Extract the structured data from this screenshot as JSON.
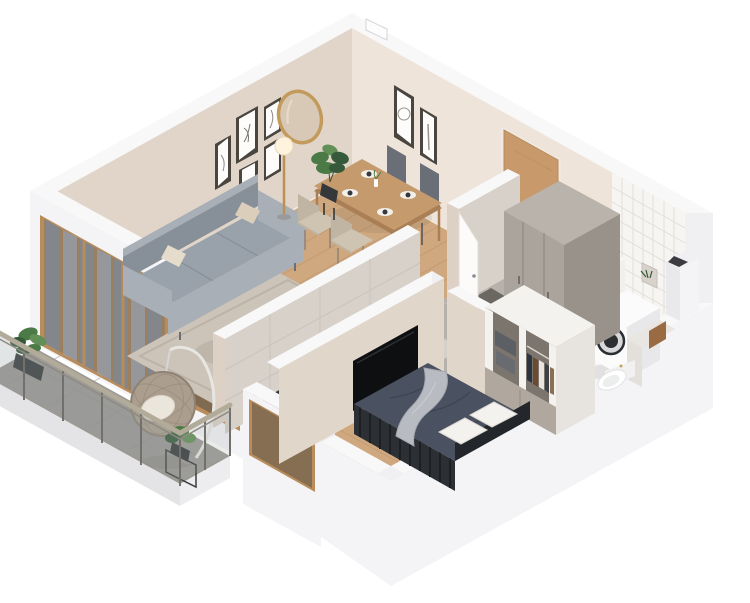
{
  "scene": {
    "title": "3D isometric cutaway render of a one-bedroom apartment floor plan",
    "background": "#ffffff"
  },
  "palette": {
    "bg": "#ffffff",
    "band": "#f8f8f9",
    "cap": "#f0f0f2",
    "outer": "#f4f4f6",
    "outerShade": "#e9e9ec",
    "wallNE": "#eee4d9",
    "wallNW": "#e1d5c9",
    "wallA": "#ddd1c5",
    "wallAside": "#d7d1ca",
    "wallB": "#e1d6ca",
    "tileWall": "#f7f5f2",
    "wood": "#cfa87f",
    "woodLine": "#b9916a",
    "hallTile": "#b6b1ab",
    "hallLine": "#c6c2bc",
    "mat": "#6b6761",
    "kitchenFloor": "#d5d0c9",
    "kitchenLine": "#c3beb7",
    "marble": "#eae8e4",
    "rug": "#ccc4b9",
    "rugLine": "#bcb3a6",
    "sofa": "#99a1aa",
    "sofaShade": "#878f98",
    "sofaLight": "#a8afb7",
    "pillowBeige": "#dbcfbc",
    "pillowBeige2": "#e6dccb",
    "tableWood": "#c59a6d",
    "tableEdge": "#aa7f55",
    "chairDark": "#6a6f77",
    "chairDarkLight": "#757a82",
    "chairLight": "#cfc4b2",
    "chairLightShade": "#c0b5a3",
    "mirrorRim": "#c29a5b",
    "mirrorFace": "#d8c8b6",
    "frameDark": "#4a463f",
    "frameFace": "#fdfcfa",
    "doorWood": "#c8996a",
    "frameWood": "#b98c5c",
    "tv": "#0d0f11",
    "counterTop": "#33363b",
    "counterFace": "#f1efec",
    "cooktop": "#141619",
    "board": "#c89a66",
    "wardrobeFront": "#aba49c",
    "wardrobeSide": "#99928a",
    "wardrobeTop": "#bab3ab",
    "partition": "#f2f0ed",
    "washer": "#fbfbfc",
    "washerShade": "#e8e8ea",
    "drum": "#2b2e31",
    "toilet": "#ffffff",
    "towel": "#9a6b42",
    "nicheFill": "#d7d2cb",
    "closetWhite": "#f4f2ef",
    "closetInner": "#7b756d",
    "drawer": "#b0a79e",
    "boxGray": "#5c6065",
    "bedDuvet": "#4a5161",
    "bedFrame": "#2c2f34",
    "headboard": "#23262b",
    "pillowWhite": "#f4f2ee",
    "throw": "#b8bbc2",
    "balconyFloor": "#9c9995",
    "balconyEdge": "#e4e4e7",
    "railTop": "#b3ab99",
    "railPost": "#73706c",
    "rattan": "#ab9e8f",
    "rattanDark": "#8f8274",
    "cushionWhite": "#ebe6dc",
    "green": "#4c7a46",
    "greenDark": "#35593a",
    "greenLight": "#628f55",
    "pot": "#35383a",
    "lampGold": "#bd9054",
    "lampGlobe": "#fff3dd",
    "shadow": "rgba(70,60,50,0.10)"
  },
  "rooms": [
    {
      "id": "living-room",
      "label": "Living room",
      "items": [
        "gray sofa",
        "beige throw pillows",
        "area rug",
        "round marble nesting coffee tables",
        "floor lamp",
        "gallery wall of framed sketches",
        "round gold mirror",
        "wall-mounted TV"
      ]
    },
    {
      "id": "dining-area",
      "label": "Dining area",
      "items": [
        "wooden dining table",
        "two dark chairs",
        "two light chairs",
        "place settings",
        "potted plant on stand",
        "two framed prints"
      ]
    },
    {
      "id": "kitchen",
      "label": "Kitchen",
      "items": [
        "dark stone countertop",
        "induction cooktop",
        "white cabinet fronts",
        "cutting board",
        "tiled backsplash wall",
        "window to balcony"
      ]
    },
    {
      "id": "hallway",
      "label": "Hallway",
      "items": [
        "wooden entrance door",
        "open white interior door",
        "tall taupe wardrobe",
        "gray tile floor",
        "dark doormat"
      ]
    },
    {
      "id": "bathroom",
      "label": "Bathroom",
      "items": [
        "washing machine",
        "toilet",
        "side cabinet",
        "white square wall tiles",
        "wall niche with plant",
        "hanging towel",
        "duct column"
      ]
    },
    {
      "id": "bedroom",
      "label": "Bedroom",
      "items": [
        "double bed with dark duvet",
        "white pillows",
        "light throw blanket",
        "slatted bed frame",
        "open closet with hanging clothes",
        "gray storage boxes",
        "drawer cabinet",
        "wall-mounted TV",
        "window with slat blinds",
        "potted plant"
      ]
    },
    {
      "id": "balcony",
      "label": "Balcony",
      "items": [
        "glass railing with metal posts",
        "hanging rattan egg chair",
        "potted plants",
        "stone tile floor"
      ]
    }
  ]
}
